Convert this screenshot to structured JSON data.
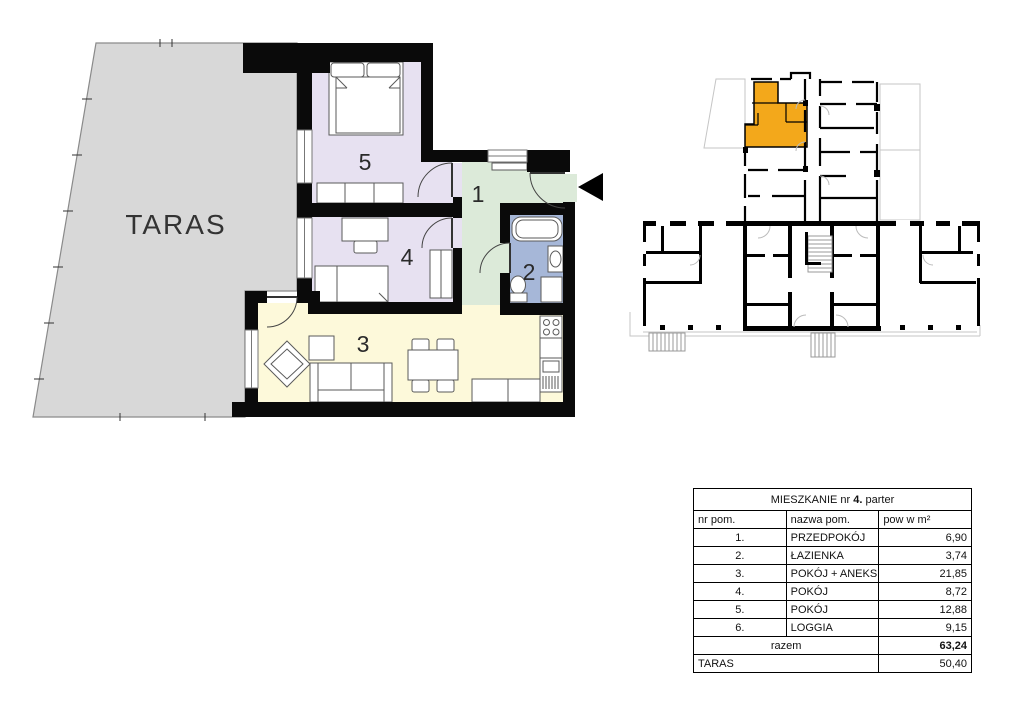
{
  "colors": {
    "taras_fill": "#d8d8d8",
    "room_lavender": "#e7e1f1",
    "room_green": "#dcead9",
    "room_blue": "#a6b7d8",
    "room_yellow": "#fdf9da",
    "highlight_unit": "#f3a81b",
    "wall": "#0a0a0a"
  },
  "plan": {
    "taras_label": "TARAS",
    "room_numbers": {
      "hall": "1",
      "bathroom": "2",
      "living": "3",
      "bedroom_small": "4",
      "bedroom_large": "5"
    }
  },
  "table": {
    "title": {
      "prefix": "MIESZKANIE nr ",
      "number": "4.",
      "suffix": " parter"
    },
    "headers": {
      "no": "nr pom.",
      "name": "nazwa pom.",
      "area": "pow w m²"
    },
    "rows": [
      {
        "no": "1.",
        "name": "PRZEDPOKÓJ",
        "area": "6,90"
      },
      {
        "no": "2.",
        "name": "ŁAZIENKA",
        "area": "3,74"
      },
      {
        "no": "3.",
        "name": "POKÓJ + ANEKS KUCH.",
        "area": "21,85"
      },
      {
        "no": "4.",
        "name": "POKÓJ",
        "area": "8,72"
      },
      {
        "no": "5.",
        "name": "POKÓJ",
        "area": "12,88"
      },
      {
        "no": "6.",
        "name": "LOGGIA",
        "area": "9,15"
      }
    ],
    "total": {
      "label": "razem",
      "value": "63,24"
    },
    "taras": {
      "label": "TARAS",
      "value": "50,40"
    }
  }
}
